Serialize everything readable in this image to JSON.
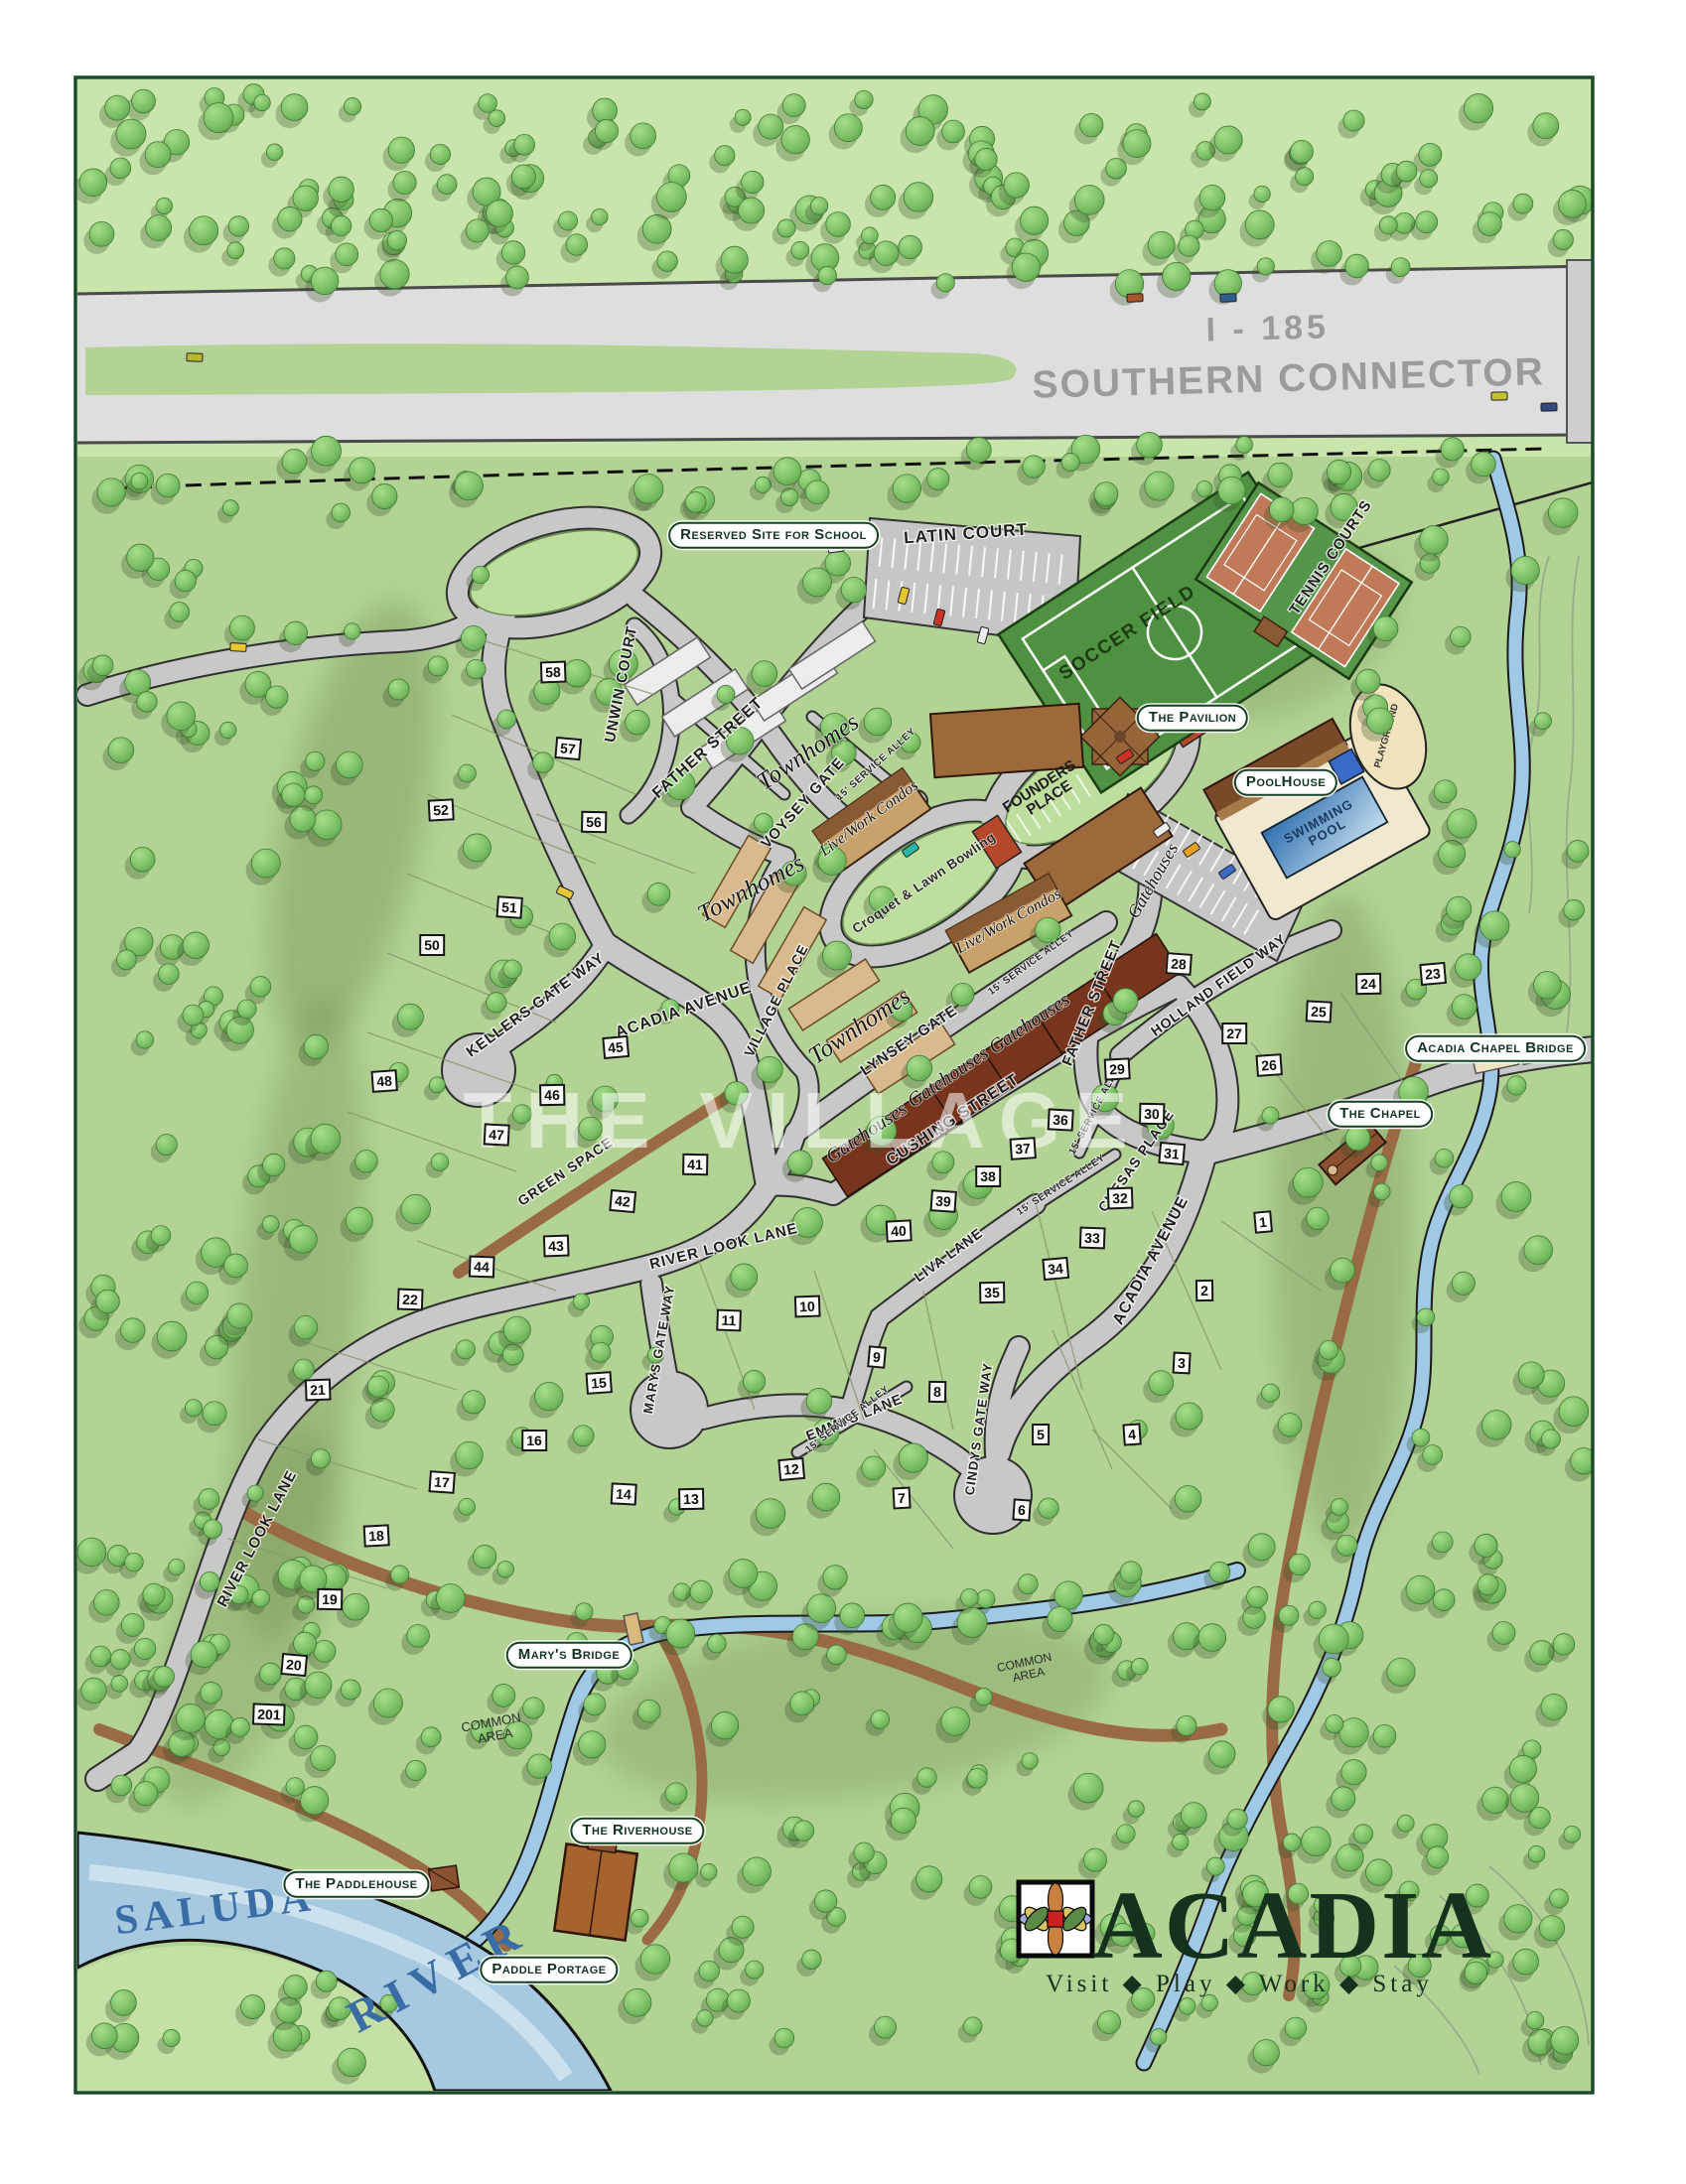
{
  "map": {
    "watermark": "THE VILLAGE",
    "highway": {
      "line1": "I - 185",
      "line2": "SOUTHERN CONNECTOR"
    },
    "river": {
      "word1": "SALUDA",
      "word2": "RIVER"
    },
    "streets": {
      "latin_court": "LATIN COURT",
      "unwin_court": "UNWIN COURT",
      "father_street": "FATHER STREET",
      "voysey_gate": "VOYSEY GATE",
      "village_place": "VILLAGE PLACE",
      "lynsey_gate": "LYNSEY GATE",
      "cushing_street": "CUSHING STREET",
      "chesas_place": "CHESAS PLACE",
      "holland_field_way": "HOLLAND FIELD WAY",
      "kellers_gate_way": "KELLERS GATE WAY",
      "acadia_avenue": "ACADIA AVENUE",
      "river_look_lane": "RIVER LOOK LANE",
      "marys_gate_way": "MARYS GATE WAY",
      "emmys_lane": "EMMYS LANE",
      "cindys_gate_way": "CINDYS GATE WAY",
      "liva_lane": "LIVA LANE",
      "service_alley": "15' SERVICE ALLEY",
      "green_space": "GREEN SPACE"
    },
    "amenities": {
      "soccer_field": "SOCCER FIELD",
      "tennis_courts": "TENNIS COURTS",
      "swimming_line1": "SWIMMING",
      "swimming_line2": "POOL",
      "playground": "PLAYGROUND",
      "founders_line1": "FOUNDERS",
      "founders_line2": "PLACE",
      "croquet": "Croquet & Lawn Bowling",
      "common_line1": "COMMON",
      "common_line2": "AREA"
    },
    "pills": {
      "reserved_school": "Reserved Site for School",
      "pavilion": "The Pavilion",
      "poolhouse": "PoolHouse",
      "chapel_bridge": "Acadia Chapel Bridge",
      "chapel": "The Chapel",
      "marys_bridge": "Mary's Bridge",
      "riverhouse": "The Riverhouse",
      "paddlehouse": "The Paddlehouse",
      "paddle_portage": "Paddle Portage"
    },
    "buildings": {
      "townhomes": "Townhomes",
      "livework": "Live/Work Condos",
      "gatehouses": "Gatehouses"
    },
    "lots": [
      "1",
      "2",
      "3",
      "4",
      "5",
      "6",
      "7",
      "8",
      "9",
      "10",
      "11",
      "12",
      "13",
      "14",
      "15",
      "16",
      "17",
      "18",
      "19",
      "20",
      "21",
      "22",
      "23",
      "24",
      "25",
      "26",
      "27",
      "28",
      "29",
      "30",
      "31",
      "32",
      "33",
      "34",
      "35",
      "36",
      "37",
      "38",
      "39",
      "40",
      "41",
      "42",
      "43",
      "44",
      "45",
      "46",
      "47",
      "48",
      "50",
      "51",
      "52",
      "56",
      "57",
      "58",
      "201"
    ],
    "logo": {
      "name": "ACADIA",
      "tagline": "Visit ◆ Play ◆ Work ◆ Stay"
    },
    "colors": {
      "frame": "#1c4a28",
      "map_green": "#b2d394",
      "top_green": "#c9e5ab",
      "road": "#c8c8c8",
      "highway": "#dedede",
      "water": "#a6c9e0",
      "logo_green": "#14321e",
      "court_clay": "#c07a57",
      "field_green": "#4e9140"
    }
  }
}
